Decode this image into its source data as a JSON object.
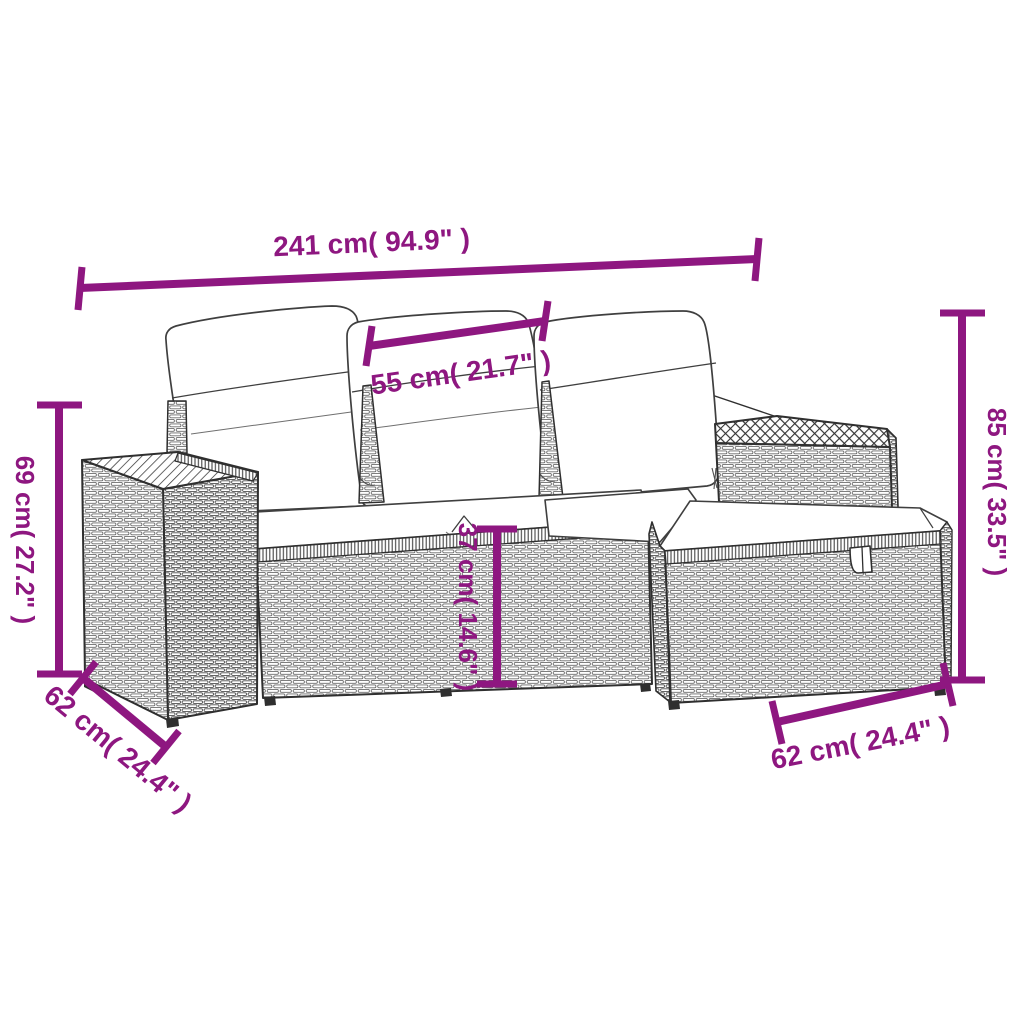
{
  "diagram": {
    "title": "4-piece rattan garden sofa set with cushions — dimension diagram",
    "style": {
      "accent_color": "#8e1780",
      "line_art_color": "#2f2f2f",
      "cushion_color": "#ffffff",
      "background_color": "#ffffff"
    },
    "dimensions": {
      "overall_width": {
        "label": "241 cm( 94.9\" )",
        "value_cm": 241,
        "value_in": 94.9
      },
      "seat_width": {
        "label": "55 cm( 21.7\" )",
        "value_cm": 55,
        "value_in": 21.7
      },
      "arm_height": {
        "label": "69 cm( 27.2\" )",
        "value_cm": 69,
        "value_in": 27.2
      },
      "back_height": {
        "label": "85 cm( 33.5\" )",
        "value_cm": 85,
        "value_in": 33.5
      },
      "seat_height": {
        "label": "37 cm( 14.6\" )",
        "value_cm": 37,
        "value_in": 14.6
      },
      "seat_depth": {
        "label": "62 cm( 24.4\" )",
        "value_cm": 62,
        "value_in": 24.4
      },
      "footstool_width": {
        "label": "62 cm( 24.4\" )",
        "value_cm": 62,
        "value_in": 24.4
      }
    }
  }
}
